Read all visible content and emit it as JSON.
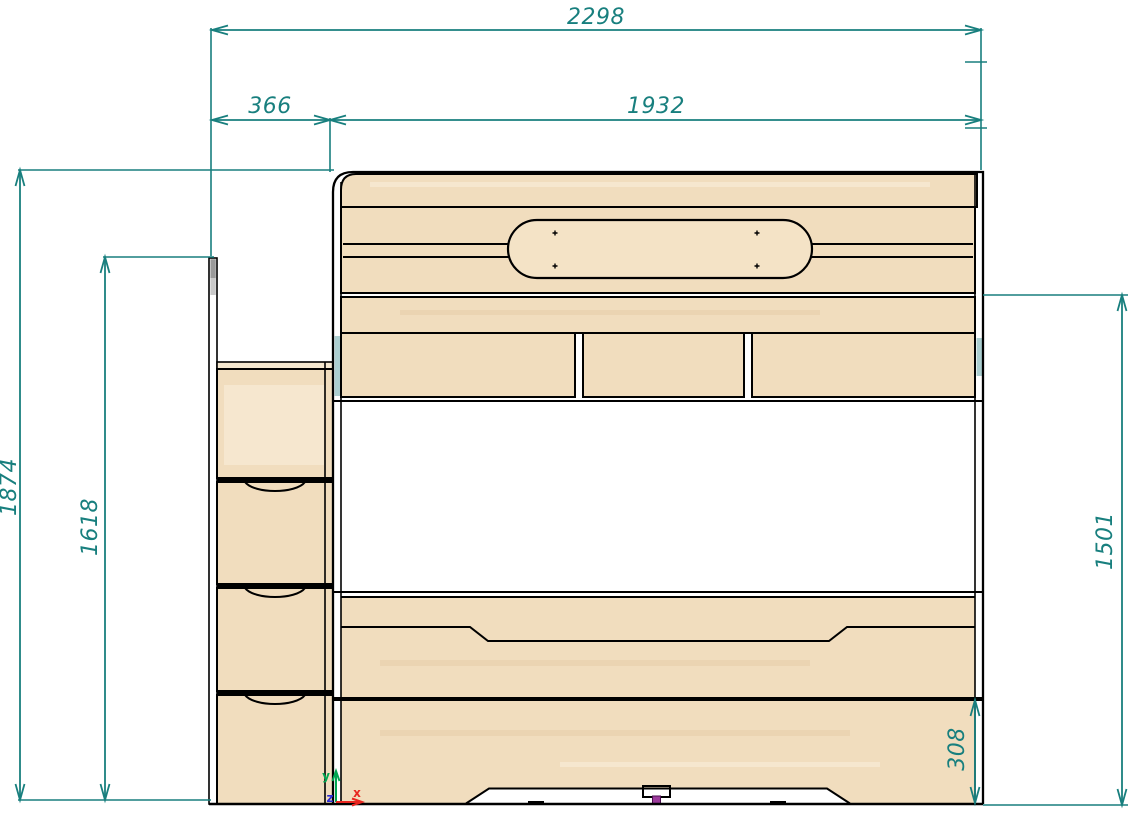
{
  "drawing": {
    "title": "bunk-bed-front-view-technical-drawing",
    "dimensions": {
      "total_width": "2298",
      "ladder_width": "366",
      "bed_width": "1932",
      "total_height": "1874",
      "ladder_height": "1618",
      "bed_height": "1501",
      "bottom_drawer_height": "308"
    },
    "origin_axes": {
      "x_label": "x",
      "y_label": "y",
      "z_label": "z"
    },
    "colors": {
      "dimension_teal": "#187f7e",
      "outline_black": "#000000",
      "wood_base": "#f1ddbe",
      "wood_light": "#f5e7cf",
      "edge_banding_cyan": "#abced0",
      "axis_x_red": "#e8251f",
      "axis_y_green": "#00a651",
      "axis_z_blue": "#2a2ad4",
      "center_leg_magenta": "#9c3b9c"
    }
  }
}
